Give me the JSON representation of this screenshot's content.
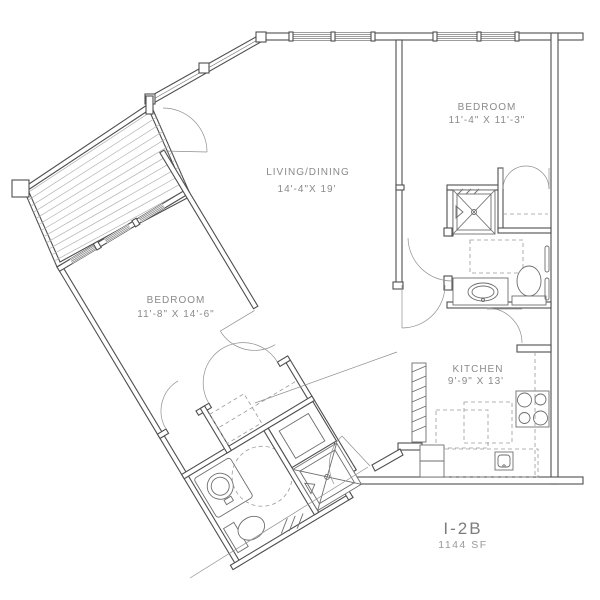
{
  "plan": {
    "unit_label": "I-2B",
    "area_label": "1144 SF",
    "rooms": [
      {
        "name": "BEDROOM",
        "dims": "11'-4\" X 11'-3\""
      },
      {
        "name": "LIVING/DINING",
        "dims": "14'-4\"X 19'"
      },
      {
        "name": "BEDROOM",
        "dims": "11'-8\" X 14'-6\""
      },
      {
        "name": "KITCHEN",
        "dims": "9'-9\" X 13'"
      }
    ],
    "fixtures": [
      "deck",
      "shower",
      "closet",
      "washer-dryer",
      "vanity-sink",
      "toilet",
      "range",
      "kitchen-island",
      "pantry"
    ],
    "colors": {
      "wall_line": "#4f4f4f",
      "fixture_line": "#6e6e6e",
      "text": "#8a8a8a",
      "background": "#ffffff"
    }
  }
}
